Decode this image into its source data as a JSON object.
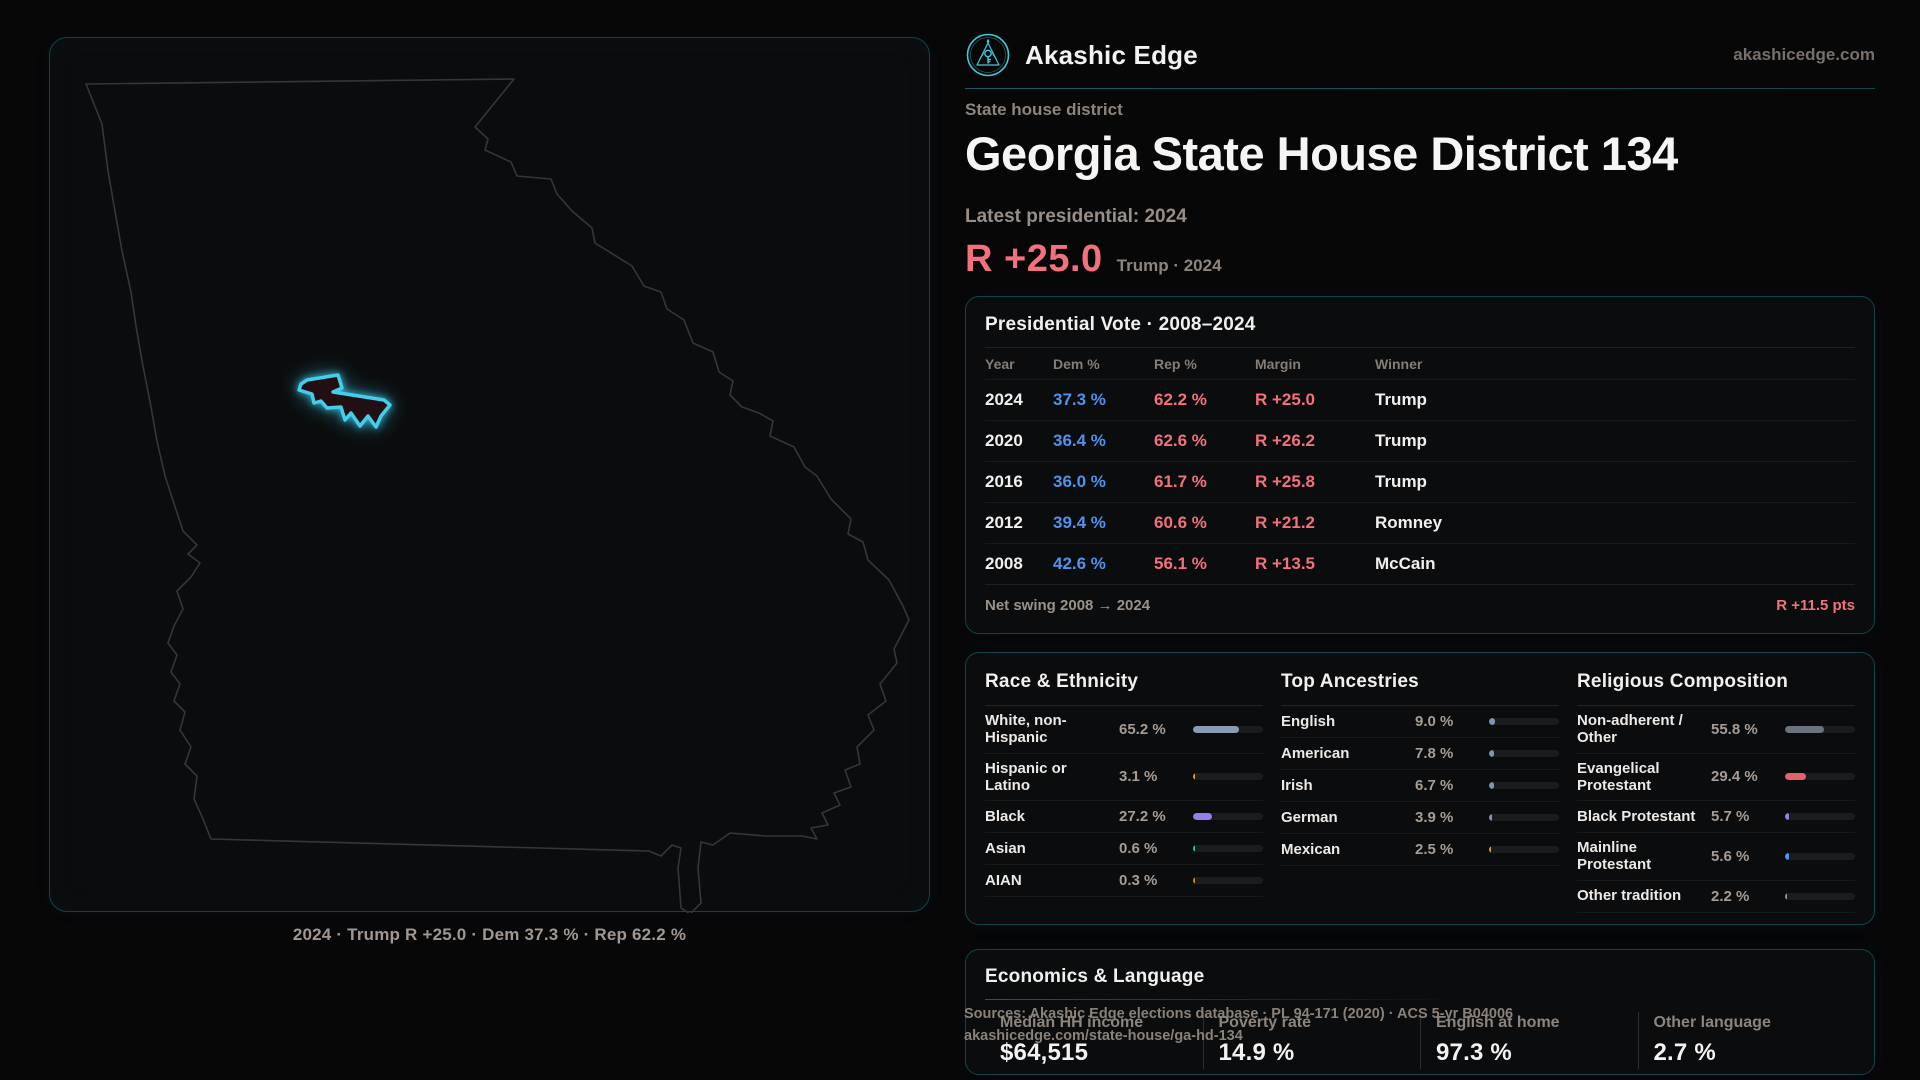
{
  "brand": {
    "name": "Akashic Edge",
    "domain": "akashicedge.com",
    "accent_teal": "#39c4d8"
  },
  "page": {
    "kicker": "State house district",
    "title": "Georgia State House District 134",
    "latest_label": "Latest presidential: 2024",
    "margin_value": "R +25.0",
    "margin_context": "Trump · 2024"
  },
  "map": {
    "caption": "2024 · Trump R +25.0 · Dem 37.3 % · Rep 62.2 %"
  },
  "presidential": {
    "title": "Presidential Vote · 2008–2024",
    "columns": [
      "Year",
      "Dem %",
      "Rep %",
      "Margin",
      "Winner"
    ],
    "rows": [
      {
        "year": "2024",
        "dem": "37.3 %",
        "rep": "62.2 %",
        "margin": "R +25.0",
        "winner": "Trump"
      },
      {
        "year": "2020",
        "dem": "36.4 %",
        "rep": "62.6 %",
        "margin": "R +26.2",
        "winner": "Trump"
      },
      {
        "year": "2016",
        "dem": "36.0 %",
        "rep": "61.7 %",
        "margin": "R +25.8",
        "winner": "Trump"
      },
      {
        "year": "2012",
        "dem": "39.4 %",
        "rep": "60.6 %",
        "margin": "R +21.2",
        "winner": "Romney"
      },
      {
        "year": "2008",
        "dem": "42.6 %",
        "rep": "56.1 %",
        "margin": "R +13.5",
        "winner": "McCain"
      }
    ],
    "net_swing_label": "Net swing 2008 → 2024",
    "net_swing_value": "R +11.5 pts",
    "dem_color": "#4f93ee",
    "rep_color": "#f2717c"
  },
  "demographics": {
    "groups": [
      {
        "title": "Race & Ethnicity",
        "rows": [
          {
            "label": "White, non-Hispanic",
            "value": "65.2 %",
            "pct": 65.2,
            "color": "#8b9bb4"
          },
          {
            "label": "Hispanic or Latino",
            "value": "3.1 %",
            "pct": 3.1,
            "color": "#e09a30"
          },
          {
            "label": "Black",
            "value": "27.2 %",
            "pct": 27.2,
            "color": "#967fe8"
          },
          {
            "label": "Asian",
            "value": "0.6 %",
            "pct": 0.6,
            "color": "#2ec49e"
          },
          {
            "label": "AIAN",
            "value": "0.3 %",
            "pct": 0.3,
            "color": "#c8822e"
          }
        ]
      },
      {
        "title": "Top Ancestries",
        "rows": [
          {
            "label": "English",
            "value": "9.0 %",
            "pct": 9.0,
            "color": "#7e94b4"
          },
          {
            "label": "American",
            "value": "7.8 %",
            "pct": 7.8,
            "color": "#7e94b4"
          },
          {
            "label": "Irish",
            "value": "6.7 %",
            "pct": 6.7,
            "color": "#7e94b4"
          },
          {
            "label": "German",
            "value": "3.9 %",
            "pct": 3.9,
            "color": "#7e94b4"
          },
          {
            "label": "Mexican",
            "value": "2.5 %",
            "pct": 2.5,
            "color": "#e09a30"
          }
        ]
      },
      {
        "title": "Religious Composition",
        "rows": [
          {
            "label": "Non-adherent / Other",
            "value": "55.8 %",
            "pct": 55.8,
            "color": "#6b7280"
          },
          {
            "label": "Evangelical Protestant",
            "value": "29.4 %",
            "pct": 29.4,
            "color": "#e4626e"
          },
          {
            "label": "Black Protestant",
            "value": "5.7 %",
            "pct": 5.7,
            "color": "#967fe8"
          },
          {
            "label": "Mainline Protestant",
            "value": "5.6 %",
            "pct": 5.6,
            "color": "#4f93ee"
          },
          {
            "label": "Other tradition",
            "value": "2.2 %",
            "pct": 2.2,
            "color": "#8f959c"
          }
        ]
      }
    ]
  },
  "economics": {
    "title": "Economics & Language",
    "stats": [
      {
        "label": "Median HH income",
        "value": "$64,515"
      },
      {
        "label": "Poverty rate",
        "value": "14.9 %"
      },
      {
        "label": "English at home",
        "value": "97.3 %"
      },
      {
        "label": "Other language",
        "value": "2.7 %"
      }
    ]
  },
  "sources": {
    "line1": "Sources: Akashic Edge elections database · PL 94-171 (2020) · ACS 5-yr B04006",
    "line2": "akashicedge.com/state-house/ga-hd-134"
  }
}
